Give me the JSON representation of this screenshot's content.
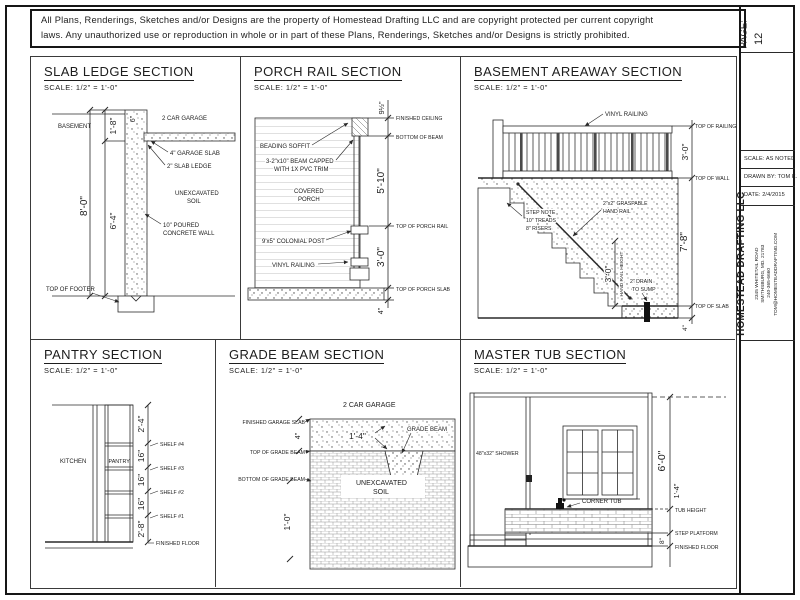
{
  "copyright": {
    "line1": "All Plans, Renderings, Sketches and/or Designs are the property of Homestead Drafting LLC and are copyright protected per current copyright",
    "line2": "laws. Any unauthorized use or reproduction in whole or in part of these Plans, Renderings, Sketches and/or Designs is strictly prohibited."
  },
  "title_block": {
    "page_label": "PAGE:",
    "page_number": "12",
    "scale": "SCALE:  AS NOTED",
    "drawn_by": "DRAWN BY:  TOM K.",
    "date": "DATE:  2/4/2015",
    "company": "HOMESTEAD DRAFTING LLC",
    "address_line1": "2345 WHITETAIL ROAD",
    "address_line2": "SMITHSBURG, MD. 21783",
    "phone": "240-365-6660",
    "email": "TOM@HOMESTEADDRAFTING.COM"
  },
  "sections": {
    "slab_ledge": {
      "title": "SLAB LEDGE SECTION",
      "scale_note": "SCALE:   1/2\" = 1'-0\"",
      "labels": {
        "basement": "BASEMENT",
        "garage": "2 CAR GARAGE",
        "garage_slab": "4\" GARAGE SLAB",
        "slab_ledge": "2\" SLAB LEDGE",
        "soil_1": "UNEXCAVATED",
        "soil_2": "SOIL",
        "wall_1": "10\" POURED",
        "wall_2": "CONCRETE WALL",
        "top_of_footer": "TOP OF FOOTER"
      },
      "dims": {
        "wall_top": "6\"",
        "upper": "1'-8\"",
        "overall": "8'-0\"",
        "lower": "6'-4\""
      }
    },
    "porch_rail": {
      "title": "PORCH RAIL SECTION",
      "scale_note": "SCALE:   1/2\" = 1'-0\"",
      "labels": {
        "soffit": "BEADING SOFFIT",
        "beam_1": "3-2\"x10\" BEAM CAPPED",
        "beam_2": "WITH 1X PVC TRIM",
        "porch_1": "COVERED",
        "porch_2": "PORCH",
        "post": "9'x5\" COLONIAL POST",
        "railing": "VINYL RAILING",
        "finished_ceiling": "FINISHED CEILING",
        "bottom_of_beam": "BOTTOM OF BEAM",
        "top_of_rail": "TOP OF PORCH RAIL",
        "top_of_slab": "TOP OF PORCH SLAB"
      },
      "dims": {
        "ceiling": "9½\"",
        "wall": "5'-10\"",
        "rail": "3'-0\"",
        "slab": "4\""
      }
    },
    "areaway": {
      "title": "BASEMENT AREAWAY SECTION",
      "scale_note": "SCALE:   1/2\" = 1'-0\"",
      "labels": {
        "railing": "VINYL RAILING",
        "top_of_railing": "TOP OF RAILING",
        "top_of_wall": "TOP OF WALL",
        "step_1": "STEP NOTE",
        "step_2": "10\" TREADS",
        "step_3": "8\" RISERS",
        "handrail_1": "2\"x2\" GRASPABLE",
        "handrail_2": "HAND RAIL",
        "handrail_height": "HAND RAIL HEIGHT",
        "drain_1": "2\" DRAIN",
        "drain_2": "TO SUMP",
        "top_of_slab": "TOP OF SLAB"
      },
      "dims": {
        "railing": "3'-0\"",
        "handrail": "3'-0\"",
        "wall": "7'-8\"",
        "slab": "4\""
      }
    },
    "pantry": {
      "title": "PANTRY SECTION",
      "scale_note": "SCALE:   1/2\" = 1'-0\"",
      "labels": {
        "kitchen": "KITCHEN",
        "pantry": "PANTRY",
        "shelf_4": "SHELF #4",
        "shelf_3": "SHELF #3",
        "shelf_2": "SHELF #2",
        "shelf_1": "SHELF #1",
        "finished_floor": "FINISHED FLOOR"
      },
      "dims": {
        "top": "2'-4\"",
        "gap_a": "16\"",
        "gap_b": "16\"",
        "gap_c": "16\"",
        "bottom": "2'-8\""
      }
    },
    "grade_beam": {
      "title": "GRADE BEAM SECTION",
      "scale_note": "SCALE:   1/2\" = 1'-0\"",
      "labels": {
        "garage": "2 CAR GARAGE",
        "grade_beam": "GRADE BEAM",
        "finished_slab": "FINISHED GARAGE SLAB",
        "beam_top": "TOP OF GRADE BEAM",
        "beam_bottom": "BOTTOM OF GRADE BEAM",
        "soil_1": "UNEXCAVATED",
        "soil_2": "SOIL"
      },
      "dims": {
        "beam_width": "1'-4\"",
        "slab": "4\"",
        "depth": "1'-0\""
      }
    },
    "master_tub": {
      "title": "MASTER TUB SECTION",
      "scale_note": "SCALE:   1/2\" = 1'-0\"",
      "labels": {
        "shower": "48\"x32\" SHOWER",
        "corner_tub": "CORNER TUB",
        "tub_height": "TUB HEIGHT",
        "step_platform": "STEP PLATFORM",
        "finished_floor": "FINISHED FLOOR"
      },
      "dims": {
        "wall": "6'-0\"",
        "tub": "1'-4\"",
        "platform": "8\""
      }
    }
  }
}
